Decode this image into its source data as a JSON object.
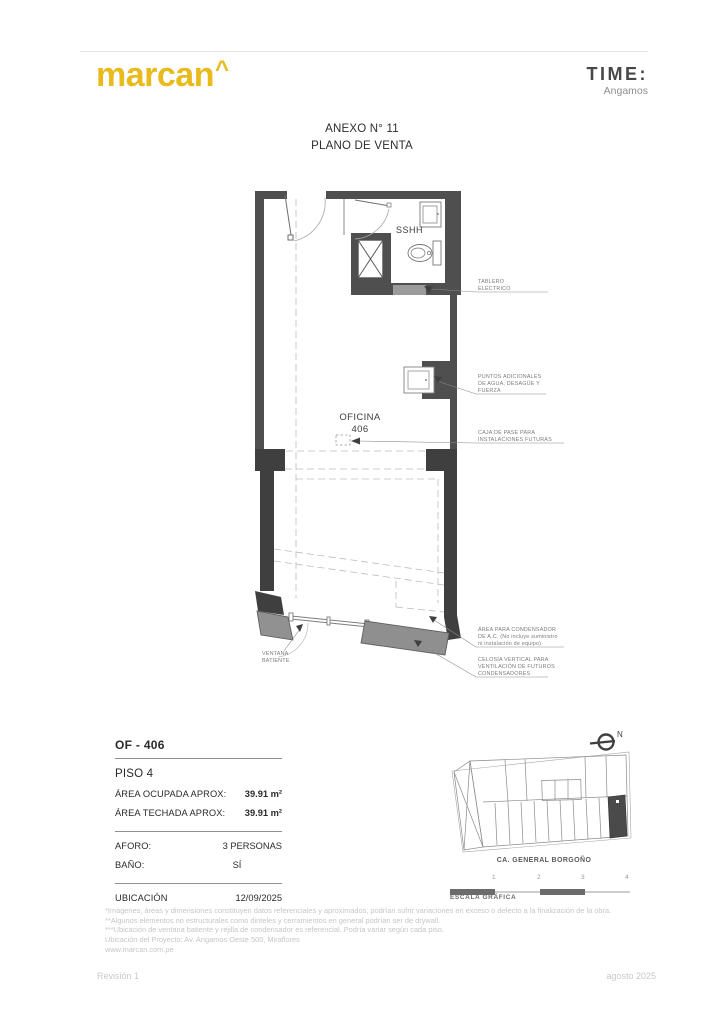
{
  "header": {
    "brand": "marcan",
    "brand_caret": "^",
    "logo_right_title": "TIME:",
    "logo_right_subtitle": "Angamos"
  },
  "title": {
    "line1": "ANEXO N° 11",
    "line2": "PLANO DE VENTA"
  },
  "plan": {
    "room_name": "OFICINA",
    "room_number": "406",
    "bath_label": "SSHH",
    "ann": {
      "tablero1": "TABLERO",
      "tablero2": "ELÉCTRICO",
      "puntos1": "PUNTOS ADICIONALES",
      "puntos2": "DE AGUA, DESAGÜE Y",
      "puntos3": "FUERZA",
      "caja1": "CAJA DE PASE PARA",
      "caja2": "INSTALACIONES FUTURAS",
      "cond1": "ÁREA PARA CONDENSADOR",
      "cond2": "DE A.C. (No incluye suministro",
      "cond3": "ni instalación de equipo)",
      "celosia1": "CELOSÍA VERTICAL PARA",
      "celosia2": "VENTILACIÓN DE FUTUROS",
      "celosia3": "CONDENSADORES",
      "ventana1": "VENTANA",
      "ventana2": "BATIENTE"
    }
  },
  "info": {
    "unit": "OF - 406",
    "floor": "PISO 4",
    "area_rows": [
      {
        "label": "ÁREA OCUPADA APROX:",
        "value": "39.91 m²"
      },
      {
        "label": "ÁREA TECHADA APROX:",
        "value": "39.91 m²"
      }
    ],
    "mid_rows": [
      {
        "label": "AFORO:",
        "value": "3 PERSONAS"
      },
      {
        "label": "BAÑO:",
        "value": "SÍ"
      }
    ],
    "bottom_row": {
      "label": "UBICACIÓN",
      "value": "12/09/2025"
    }
  },
  "siteplan": {
    "street": "CA. GENERAL BORGOÑO",
    "north_label": "N",
    "scale_numbers": [
      "1",
      "2",
      "3",
      "4"
    ],
    "scale_label": "ESCALA GRÁFICA"
  },
  "notes": [
    "*Imágenes, áreas y dimensiones constituyen datos referenciales y aproximados, podrían sufrir variaciones en exceso o defecto a la finalización de la obra.",
    "**Algunos elementos no estructurales como dinteles y cerramientos en general podrían ser de drywall.",
    "***Ubicación de ventana batiente y rejilla de condensador es referencial. Podría variar según cada piso.",
    "Ubicación del Proyecto: Av. Angamos Oeste 500, Miraflores",
    "www.marcan.com.pe"
  ],
  "footer": {
    "left": "Revisión 1",
    "right": "agosto 2025"
  },
  "colors": {
    "brand_yellow": "#E9BA1C",
    "wall_dark": "#4F4F4F",
    "wall_darker": "#3F3F3F",
    "panel_gray": "#919191",
    "tablero_gray": "#9B9B9B",
    "note_gray": "#C6C6C6"
  }
}
